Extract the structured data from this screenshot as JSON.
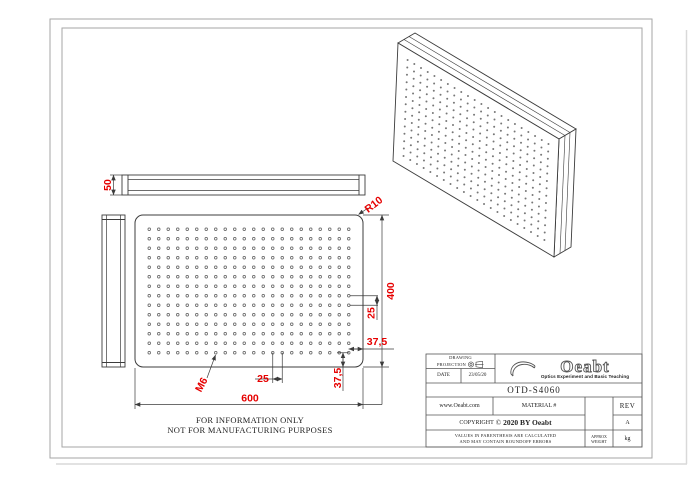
{
  "colors": {
    "dimension_red": "#e60000",
    "line_dark": "#3c3c3c",
    "frame_gray": "#a6a6a6"
  },
  "dimensions": {
    "width": "600",
    "height": "400",
    "thickness": "50",
    "corner_radius": "R10",
    "hole_spacing_x": "25",
    "hole_spacing_y": "25",
    "edge_margin_x": "37,5",
    "edge_margin_y": "37,5",
    "thread": "M6"
  },
  "hole_grid": {
    "cols": 22,
    "rows": 14
  },
  "notes": {
    "line1": "FOR INFORMATION ONLY",
    "line2": "NOT FOR MANUFACTURING PURPOSES"
  },
  "title_block": {
    "projection_label_line1": "DRAWING",
    "projection_label_line2": "PROJECTION",
    "date_label": "DATE",
    "date_value": "23/05/20",
    "part_number": "OTD-S4060",
    "website": "www.Oeabt.com",
    "material_label": "MATERIAL #",
    "rev_label": "REV",
    "rev_value": "A",
    "copyright_prefix": "COPYRIGHT",
    "copyright_symbol": "©",
    "copyright_text": "2020 BY Oeabt",
    "disclaimer_line1": "VALUES IN PARENTHESIS ARE CALCULATED",
    "disclaimer_line2": "AND MAY CONTAIN ROUNDOFF ERRORS",
    "approx_weight_line1": "APPROX",
    "approx_weight_line2": "WEIGHT",
    "weight_unit": "kg",
    "logo_text": "Oeabt",
    "logo_tagline": "Optics Experiment and Basic Teaching"
  }
}
